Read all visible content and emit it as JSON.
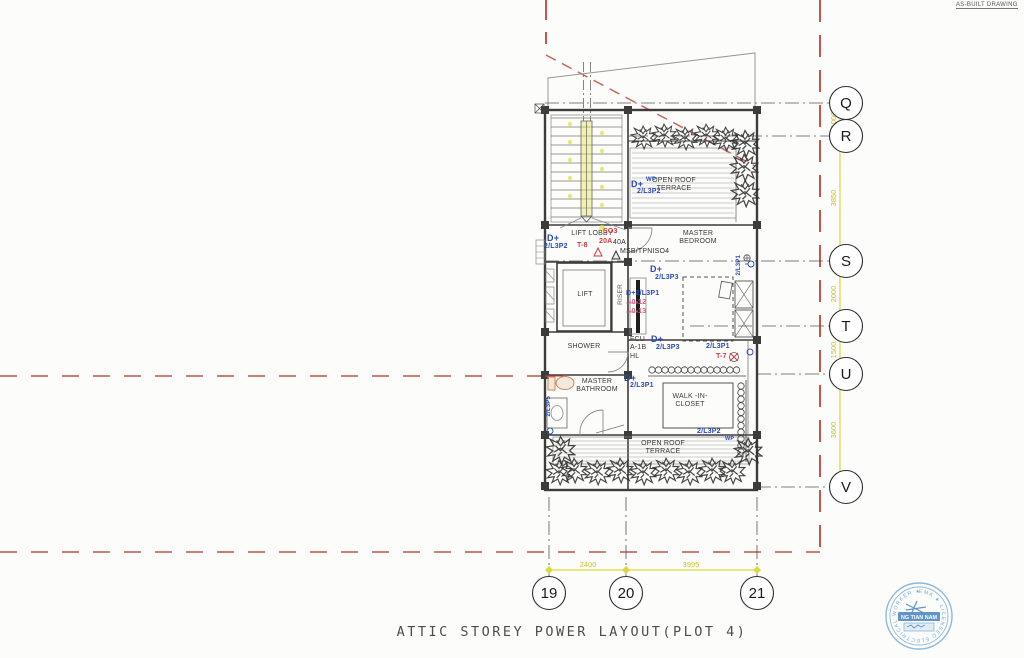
{
  "page": {
    "as_built": "AS-BUILT DRAWING",
    "title": "ATTIC STOREY POWER LAYOUT(PLOT 4)"
  },
  "grid": {
    "rows": [
      "Q",
      "R",
      "S",
      "T",
      "U",
      "V"
    ],
    "cols": [
      "19",
      "20",
      "21"
    ],
    "right_dims": [
      "1000",
      "3850",
      "2000",
      "1500",
      "3600"
    ],
    "bottom_dims": [
      "2400",
      "3995"
    ]
  },
  "rooms": {
    "terrace_top": "OPEN ROOF TERRACE",
    "lift_lobby": "LIFT LOBBY",
    "lift": "LIFT",
    "riser": "RISER",
    "master_bedroom": "MASTER BEDROOM",
    "shower": "SHOWER",
    "master_bathroom": "MASTER BATHROOM",
    "walk_in_closet": "WALK -IN- CLOSET",
    "terrace_bottom": "OPEN ROOF TERRACE",
    "fcu": "FCU A-1B HL"
  },
  "ann": [
    {
      "text": "D+"
    },
    {
      "text": "WP"
    },
    {
      "text": "2/L3P2"
    },
    {
      "text": "D+"
    },
    {
      "text": "2/L3P2"
    },
    {
      "text": "T-8"
    },
    {
      "text": "SO3"
    },
    {
      "text": "20A"
    },
    {
      "text": "40A"
    },
    {
      "text": "MSB/TPNISO4"
    },
    {
      "text": "D+"
    },
    {
      "text": "2/L3P3"
    },
    {
      "text": "D+2/L3P1"
    },
    {
      "text": "-0-12"
    },
    {
      "text": "-0-13"
    },
    {
      "text": "D+"
    },
    {
      "text": "2/L3P3"
    },
    {
      "text": "2/L3P1"
    },
    {
      "text": "2/L3P1"
    },
    {
      "text": "T-7"
    },
    {
      "text": "D+"
    },
    {
      "text": "2/L3P1"
    },
    {
      "text": "2/L3P5"
    },
    {
      "text": "2/L3P2"
    },
    {
      "text": "WP"
    }
  ],
  "stamp": {
    "arc_text": "EMA ★ LICENSED ELECTRICAL WORKER ★",
    "name": "NG TIAN NAM"
  },
  "colors": {
    "dimension_yellow": "#ddd83f",
    "boundary_red": "#c9544a",
    "circuit_blue": "#2b4bb5",
    "alert_red": "#d03a3a",
    "tag_pink": "#d8608a",
    "stamp_blue": "#5b9bd0"
  }
}
